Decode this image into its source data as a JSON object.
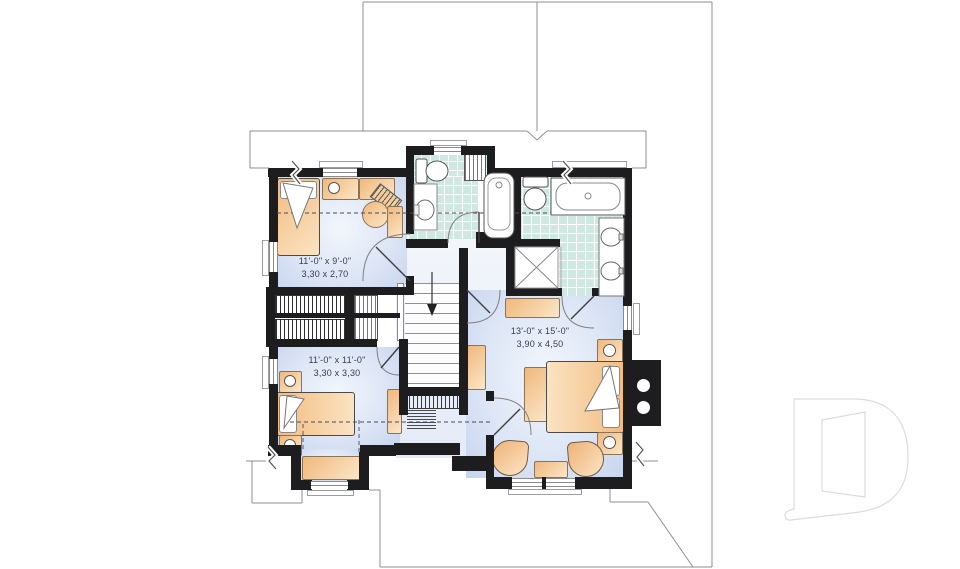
{
  "floorplan": {
    "type": "second-floor house plan",
    "rooms": [
      {
        "name": "bedroom-upper-left",
        "dim_imperial": "11'-0\" x 9'-0\"",
        "dim_metric": "3,30 x 2,70"
      },
      {
        "name": "bedroom-lower-left",
        "dim_imperial": "11'-0\" x 11'-0\"",
        "dim_metric": "3,30 x 3,30"
      },
      {
        "name": "master-bedroom",
        "dim_imperial": "13'-0\" x 15'-0\"",
        "dim_metric": "3,90 x 4,50"
      }
    ],
    "colors": {
      "wall": "#1d1d20",
      "floor_blue": "#cdd9f0",
      "tile_teal": "#cfe8e2",
      "furniture_orange": "#f5c48d",
      "outline_gray": "#8f8f8f",
      "label_text": "#3a3a52",
      "logo_gray": "#dcdcdc"
    },
    "watermark_letter": "D",
    "stairs_direction": "down"
  }
}
